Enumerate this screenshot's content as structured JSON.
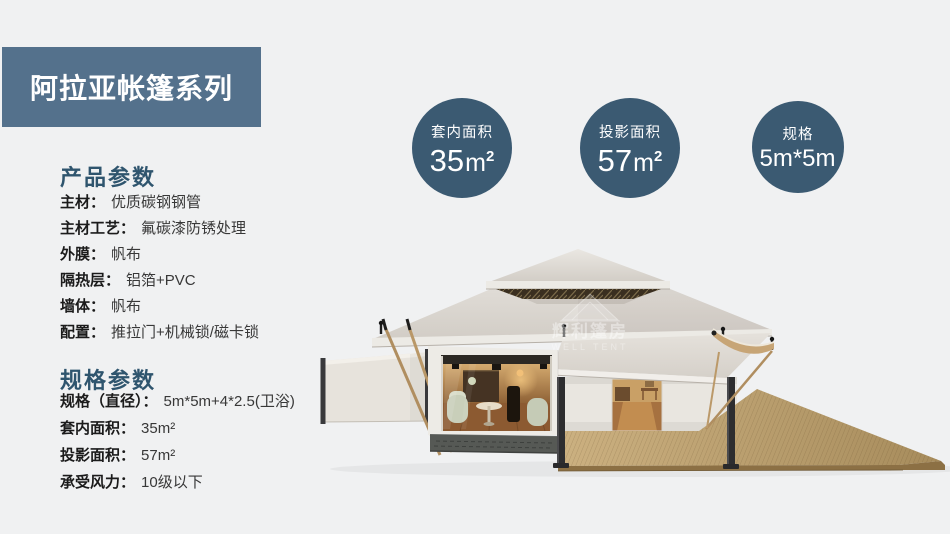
{
  "banner": {
    "title": "阿拉亚帐篷系列"
  },
  "product_params": {
    "heading": "产品参数",
    "items": [
      {
        "label": "主材：",
        "value": "优质碳钢钢管"
      },
      {
        "label": "主材工艺：",
        "value": "氟碳漆防锈处理"
      },
      {
        "label": "外膜：",
        "value": "帆布"
      },
      {
        "label": "隔热层：",
        "value": "铝箔+PVC"
      },
      {
        "label": "墙体：",
        "value": "帆布"
      },
      {
        "label": "配置：",
        "value": "推拉门+机械锁/磁卡锁"
      }
    ]
  },
  "spec_params": {
    "heading": "规格参数",
    "items": [
      {
        "label": "规格（直径）：",
        "value": "5m*5m+4*2.5(卫浴)"
      },
      {
        "label": "套内面积：",
        "value": "35m²"
      },
      {
        "label": "投影面积：",
        "value": "57m²"
      },
      {
        "label": "承受风力：",
        "value": "10级以下"
      }
    ]
  },
  "badges": [
    {
      "label": "套内面积",
      "value": "35",
      "unit": "m",
      "sup": "2"
    },
    {
      "label": "投影面积",
      "value": "57",
      "unit": "m",
      "sup": "2"
    },
    {
      "label": "规格",
      "value": "5m*5m",
      "unit": "",
      "sup": ""
    }
  ],
  "tent_image": {
    "watermark_line1": "辉利篷房",
    "watermark_line2": "WELL TENT"
  },
  "colors": {
    "background": "#f0f1f2",
    "banner_bg": "#54718c",
    "badge_bg": "#3b5a72",
    "heading_color": "#2f556e",
    "label_text": "#1b1b1b",
    "value_text": "#383838",
    "roof_cream": "#e0dcd6",
    "deck_wood": "#b3986a",
    "post_black": "#2d2d2f",
    "rope_tan": "#b08e60"
  }
}
